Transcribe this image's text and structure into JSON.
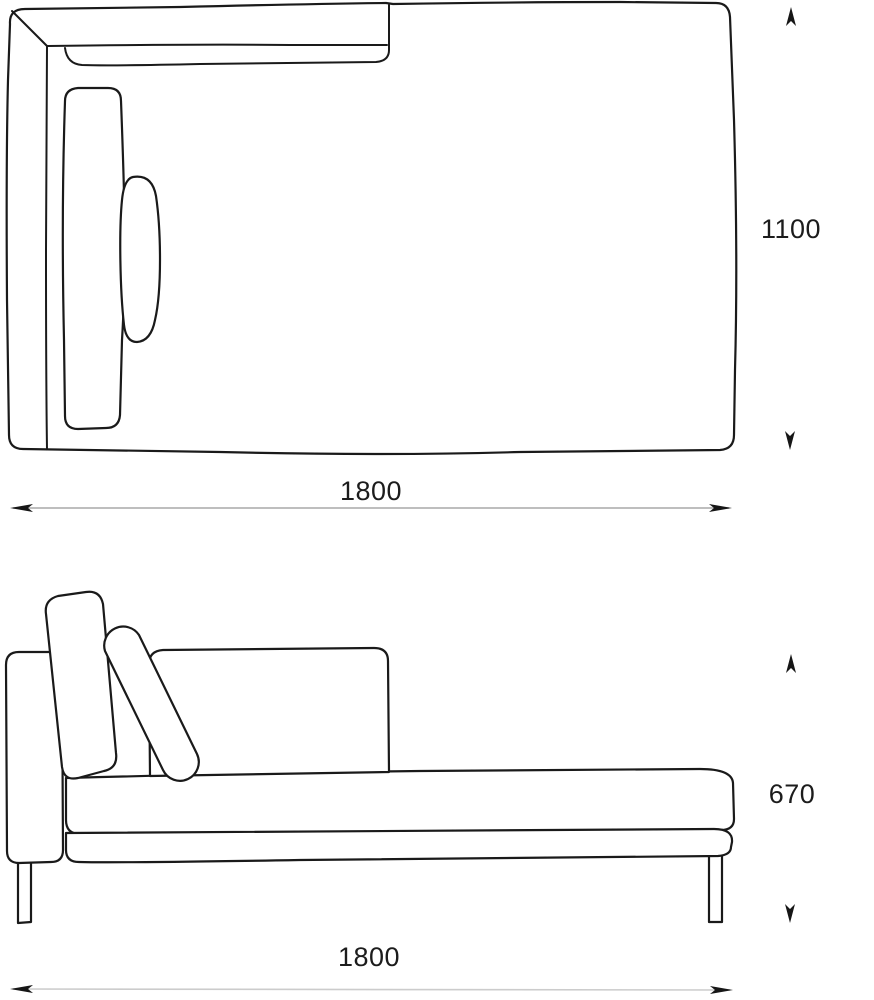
{
  "dimensions": {
    "top_view": {
      "width": "1800",
      "depth": "1100"
    },
    "side_view": {
      "length": "1800",
      "height": "670"
    }
  },
  "colors": {
    "outline": "#1a1a1a",
    "dimension_line": "#a8a8a8",
    "dimension_line_light": "#cccccc",
    "arrow": "#161616",
    "label_text": "#1c1c1c",
    "background": "#ffffff"
  }
}
